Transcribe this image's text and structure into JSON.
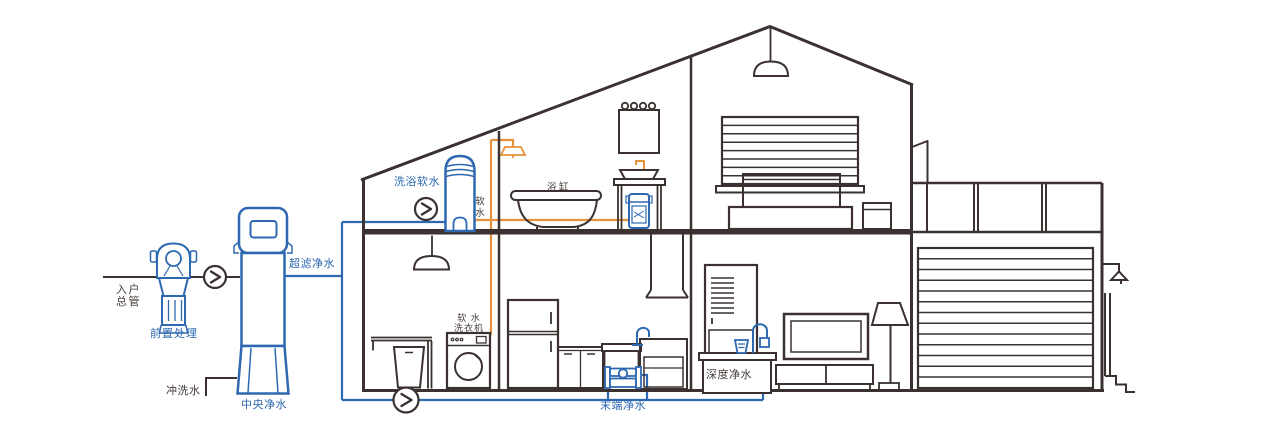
{
  "colors": {
    "pipe_blue": "#2d68b0",
    "pipe_orange": "#e6913c",
    "line_dark": "#3a3130",
    "label_dark": "#453c39",
    "background": "#ffffff"
  },
  "labels": {
    "entry_line1": "入户",
    "entry_line2": "总管",
    "pre_treatment": "前置处理",
    "central_purifier": "中央净水",
    "flush_water": "冲洗水",
    "ultrafiltration": "超滤净水",
    "shower_softener": "洗浴软水",
    "soft_water": "软水",
    "bathtub": "浴缸",
    "washer_line1": "软 水",
    "washer_line2": "洗衣机",
    "terminal_purifier": "末端净水",
    "deep_purifier": "深度净水"
  },
  "icons": {
    "flow_indicator": "chevron-right-in-circle"
  }
}
